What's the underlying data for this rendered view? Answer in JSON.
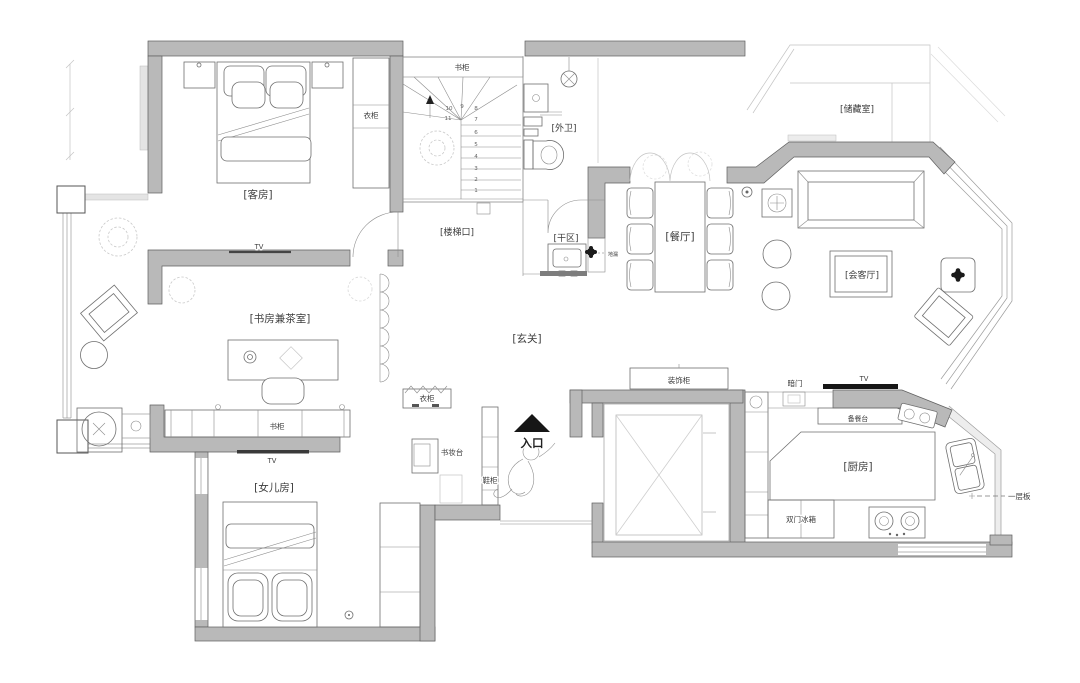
{
  "plan_type": "residential-floor-plan",
  "rooms": {
    "guest_room": "[客房]",
    "stair_opening": "[楼梯口]",
    "outer_bathroom": "[外卫]",
    "dry_area": "[干区]",
    "dining_room": "[餐厅]",
    "storage_room": "[储藏室]",
    "reception_room": "[会客厅]",
    "study_tea_room": "[书房兼茶室]",
    "foyer": "[玄关]",
    "daughter_room": "[女儿房]",
    "kitchen": "[厨房]"
  },
  "furniture_labels": {
    "guest_wardrobe": "衣柜",
    "stair_bookcase": "书柜",
    "study_bookcase": "书柜",
    "guest_tv": "TV",
    "study_tv": "TV",
    "living_tv": "TV",
    "foyer_wardrobe": "衣柜",
    "vanity_desk": "书妆台",
    "shoe_cabinet": "鞋柜",
    "decor_cabinet": "装饰柜",
    "hidden_door": "暗门",
    "prep_counter": "备餐台",
    "fridge": "双门冰箱",
    "shelf_board": "一层板",
    "drain_note": "地漏"
  },
  "entrance": {
    "label": "入口"
  },
  "stairs": {
    "numbers": [
      "1",
      "2",
      "3",
      "4",
      "5",
      "6",
      "7",
      "8",
      "9",
      "10",
      "11"
    ]
  },
  "colors": {
    "wall_fill": "#b9b9b9",
    "wall_stroke": "#5f5f5f",
    "furniture_line": "#6f6f6f",
    "light_line": "#c4c4c4",
    "accent_black": "#161616"
  }
}
